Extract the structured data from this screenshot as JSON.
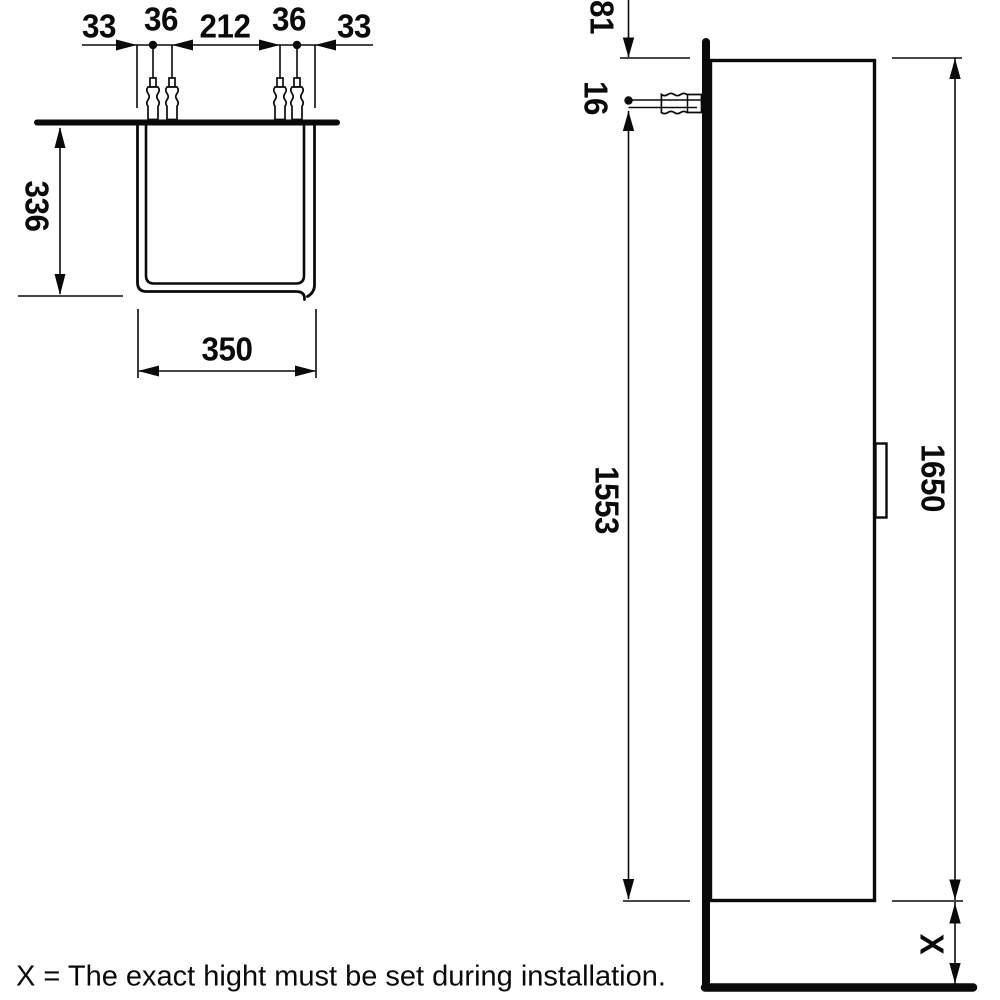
{
  "drawing": {
    "title_hint": "Tall cabinet installation drawing",
    "caption": "X = The exact hight must be set during installation.",
    "colors": {
      "ink": "#0a0a0a",
      "background": "#ffffff"
    },
    "top_view": {
      "dims": {
        "left_offset": "33",
        "left_plug_spacing": "36",
        "center_spacing": "212",
        "right_plug_spacing": "36",
        "right_offset": "33",
        "depth": "336",
        "width": "350"
      }
    },
    "side_view": {
      "dims": {
        "top_to_screw": "81",
        "screw_spacing": "16",
        "screw_to_bottom": "1553",
        "height": "1650",
        "floor_clearance": "X"
      }
    }
  }
}
